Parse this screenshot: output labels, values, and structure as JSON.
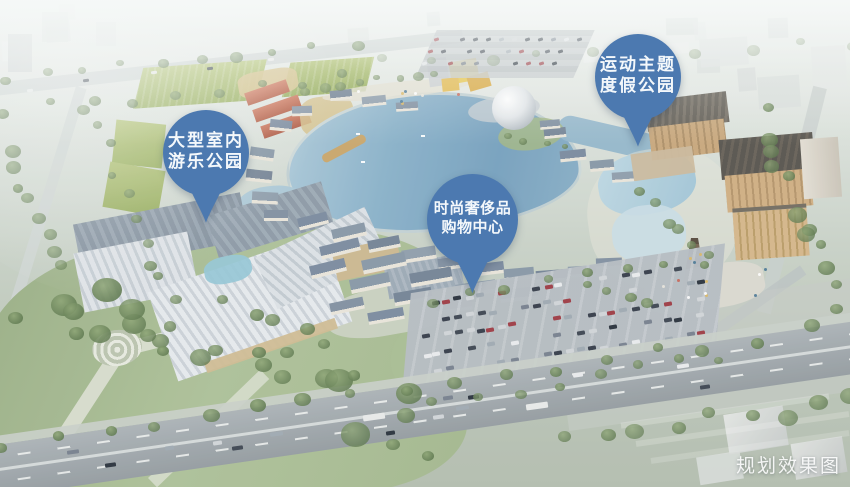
{
  "scene": {
    "description_label": "aerial planning rendering",
    "colors": {
      "callout_blue": "#4c79b0",
      "callout_text": "#f4f8fb",
      "water_blue": "#7fa6c0",
      "field_green": "#a3b75f",
      "watermark_white": "#ffffff"
    }
  },
  "callouts": [
    {
      "id": "indoor-amusement-park",
      "line1": "大型室内",
      "line2": "游乐公园"
    },
    {
      "id": "sports-theme-resort",
      "line1": "运动主题",
      "line2": "度假公园"
    },
    {
      "id": "luxury-shopping-center",
      "line1": "时尚奢侈品",
      "line2": "购物中心"
    }
  ],
  "watermark": {
    "text": "规划效果图"
  }
}
